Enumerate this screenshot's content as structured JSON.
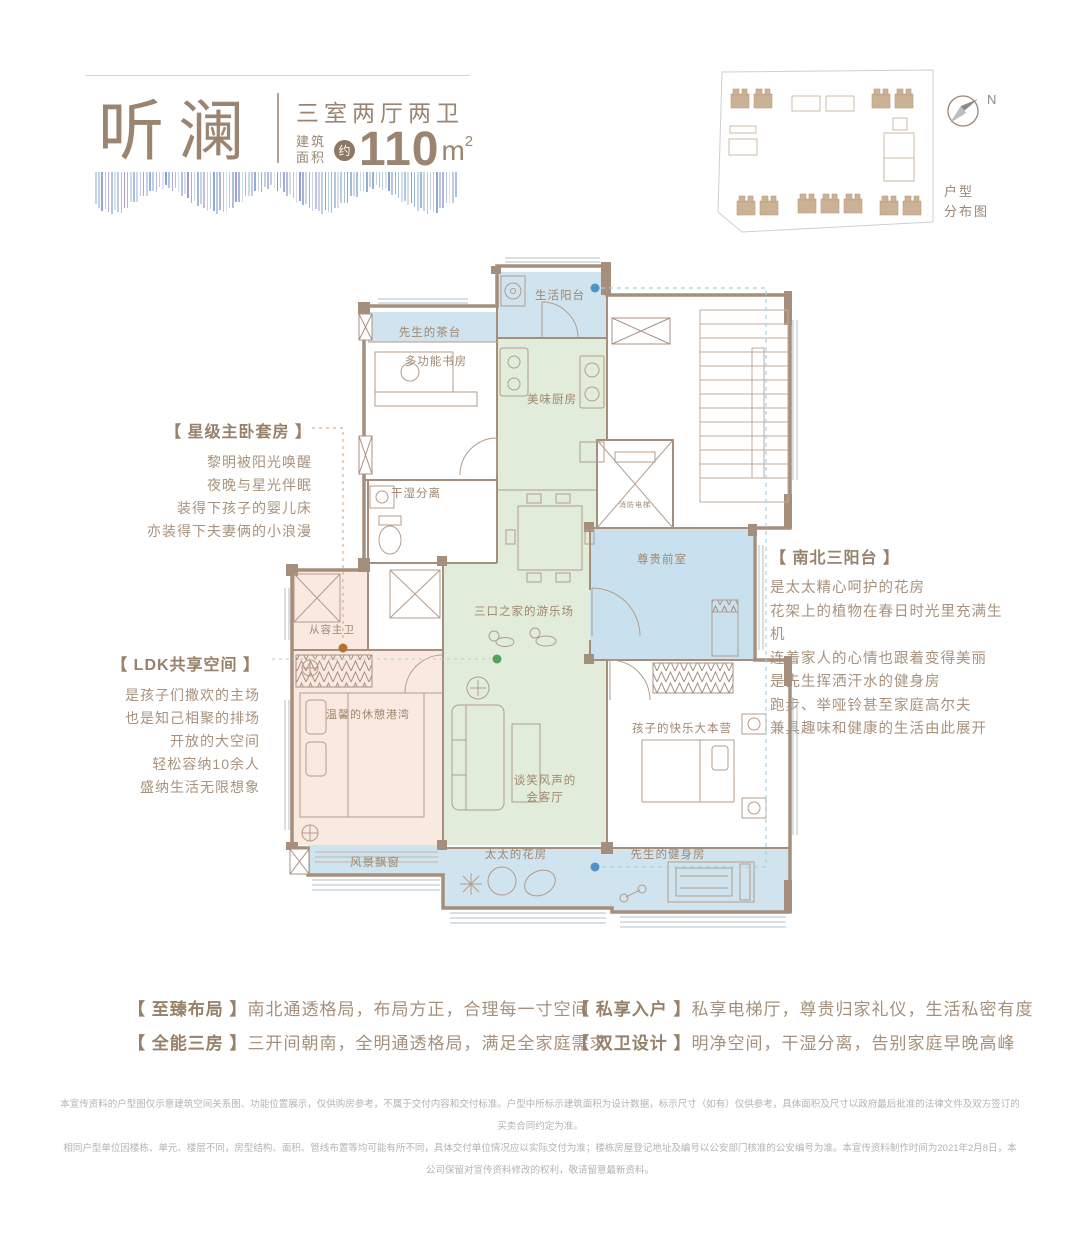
{
  "header": {
    "title": "听澜",
    "layout": "三室两厅两卫",
    "area_prefix_line1": "建筑",
    "area_prefix_line2": "面积",
    "area_approx": "约",
    "area_value": "110",
    "area_unit": "m",
    "area_sup": "2"
  },
  "siteplan": {
    "north_label": "N",
    "caption_line1": "户型",
    "caption_line2": "分布图"
  },
  "annotations": {
    "master_suite": {
      "heading": "【 星级主卧套房 】",
      "lines": [
        "黎明被阳光唤醒",
        "夜晚与星光伴眠",
        "装得下孩子的婴儿床",
        "亦装得下夫妻俩的小浪漫"
      ]
    },
    "ldk": {
      "heading": "【 LDK共享空间 】",
      "lines": [
        "是孩子们撒欢的主场",
        "也是知己相聚的排场",
        "开放的大空间",
        "轻松容纳10余人",
        "盛纳生活无限想象"
      ]
    },
    "balconies": {
      "heading": "【 南北三阳台 】",
      "lines": [
        "是太太精心呵护的花房",
        "花架上的植物在春日时光里充满生机",
        "连着家人的心情也跟着变得美丽",
        "是先生挥洒汗水的健身房",
        "跑步、举哑铃甚至家庭高尔夫",
        "兼具趣味和健康的生活由此展开"
      ]
    }
  },
  "plan": {
    "rooms": [
      {
        "name": "life-balcony",
        "label": "生活阳台"
      },
      {
        "name": "tea-bar",
        "label": "先生的茶台"
      },
      {
        "name": "study",
        "label": "多功能书房"
      },
      {
        "name": "kitchen",
        "label": "美味厨房"
      },
      {
        "name": "bath-dry-wet",
        "label": "干湿分离"
      },
      {
        "name": "fire-elevator",
        "label": "消防电梯"
      },
      {
        "name": "foyer",
        "label": "尊贵前室"
      },
      {
        "name": "master-bath",
        "label": "从容主卫"
      },
      {
        "name": "playground",
        "label": "三口之家的游乐场"
      },
      {
        "name": "master-bedroom",
        "label": "温馨的休憩港湾"
      },
      {
        "name": "living-line1",
        "label": "谈笑风声的"
      },
      {
        "name": "living-line2",
        "label": "会客厅"
      },
      {
        "name": "bay-window",
        "label": "风景飘窗"
      },
      {
        "name": "flower-room",
        "label": "太太的花房"
      },
      {
        "name": "gym",
        "label": "先生的健身房"
      },
      {
        "name": "kids-room",
        "label": "孩子的快乐大本营"
      }
    ]
  },
  "features": [
    {
      "tag": "【 至臻布局 】",
      "text": "南北通透格局，布局方正，合理每一寸空间"
    },
    {
      "tag": "【 全能三房 】",
      "text": "三开间朝南，全明通透格局，满足全家庭需求"
    },
    {
      "tag": "【 私享入户 】",
      "text": "私享电梯厅，尊贵归家礼仪，生活私密有度"
    },
    {
      "tag": "【 双卫设计 】",
      "text": "明净空间，干湿分离，告别家庭早晚高峰"
    }
  ],
  "disclaimer": {
    "line1": "本宣传资料的户型图仅示意建筑空间关系图、功能位置展示，仅供购房参考，不属于交付内容和交付标准。户型中所标示建筑面积为设计数据，标示尺寸（如有）仅供参考，具体面积及尺寸以政府最后批准的法律文件及双方签订的买卖合同约定为准。",
    "line2": "相同户型单位因楼栋、单元、楼层不同，房型结构、面积、管线布置等均可能有所不同，具体交付单位情况应以实际交付为准；楼栋房屋登记地址及编号以公安部门核准的公安编号为准。本宣传资料制作时间为2021年2月8日，本公司保留对宣传资料修改的权利，敬请留意最新资料。"
  },
  "palette": {
    "accent_brown": "#9b8470",
    "wall": "#a68e7c",
    "room_blue": "#cfe4ef",
    "room_green": "#e1ecda",
    "room_pink": "#f9e9e1",
    "dot_blue": "#4f93c3",
    "dot_green": "#56a05c",
    "dot_orange": "#b5712f",
    "wave_colors": [
      "#8aa8d0",
      "#a4bddd",
      "#b9cce4",
      "#9a8fc8",
      "#7b9cc8"
    ]
  }
}
